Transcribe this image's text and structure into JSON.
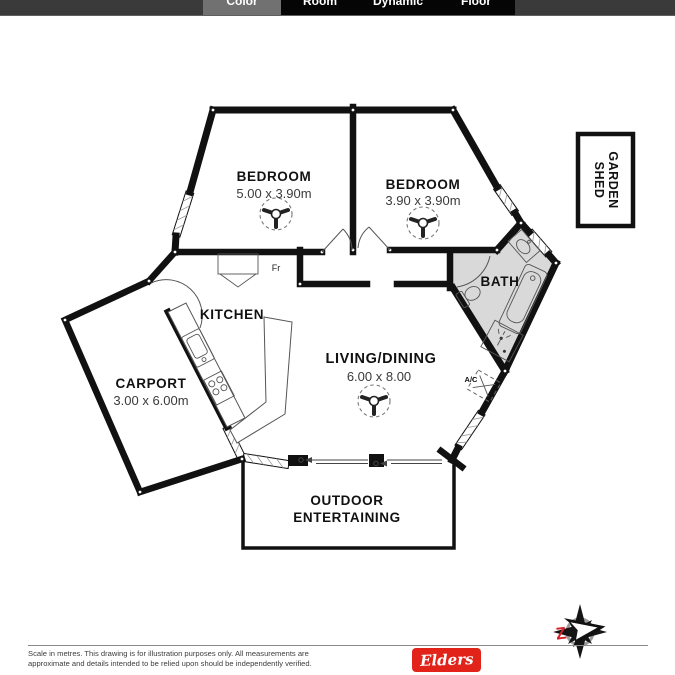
{
  "tabs": {
    "items": [
      {
        "label": "Color",
        "selected": true
      },
      {
        "label": "Room",
        "selected": false
      },
      {
        "label": "Dynamic",
        "selected": false
      },
      {
        "label": "Floor",
        "selected": false
      }
    ]
  },
  "rooms": {
    "bedroom1": {
      "name": "BEDROOM",
      "dims": "5.00 x 3.90m"
    },
    "bedroom2": {
      "name": "BEDROOM",
      "dims": "3.90 x 3.90m"
    },
    "bath": {
      "name": "BATH"
    },
    "kitchen": {
      "name": "KITCHEN"
    },
    "carport": {
      "name": "CARPORT",
      "dims": "3.00 x 6.00m"
    },
    "living": {
      "name": "LIVING/DINING",
      "dims": "6.00 x 8.00"
    },
    "outdoor": {
      "line1": "OUTDOOR",
      "line2": "ENTERTAINING"
    },
    "garden_shed": {
      "line1": "GARDEN",
      "line2": "SHED"
    }
  },
  "labels": {
    "fridge": "Fr",
    "ac": "A/C"
  },
  "footer": {
    "disclaimer_line1": "Scale in metres. This drawing is for illustration purposes only. All measurements are",
    "disclaimer_line2": "approximate and details intended to be relied upon should be independently verified.",
    "logo": "Elders",
    "compass_letter": "Z"
  },
  "colors": {
    "wall": "#111111",
    "bath_fill": "#d9d9d9",
    "logo_red": "#e2231a",
    "tab_bar_bg": "#3a3a3a",
    "tab_selected_bg": "#717171",
    "tab_group_bg": "#050505",
    "tab_text": "#ffffff"
  }
}
